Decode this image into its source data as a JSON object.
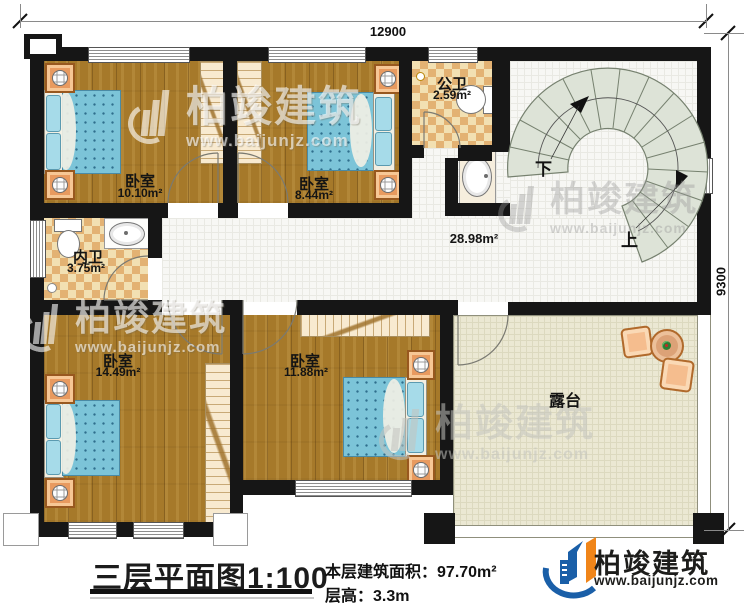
{
  "dims": {
    "width": "12900",
    "height": "9300"
  },
  "rooms": [
    {
      "name": "卧室",
      "area": "10.10m²"
    },
    {
      "name": "卧室",
      "area": "8.44m²"
    },
    {
      "name": "公卫",
      "area": "2.59m²"
    },
    {
      "name": "内卫",
      "area": "3.75m²"
    },
    {
      "name": "卧室",
      "area": "14.49m²"
    },
    {
      "name": "卧室",
      "area": "11.88m²"
    },
    {
      "name": "露台",
      "area": ""
    }
  ],
  "hall": {
    "area": "28.98m²"
  },
  "stairs": {
    "down": "下",
    "up": "上"
  },
  "title": {
    "name": "三层平面图",
    "scale": "1:100"
  },
  "stats": {
    "area_label": "本层建筑面积：",
    "area_value": "97.70m²",
    "height_label": "层高：",
    "height_value": "3.3m"
  },
  "brand": {
    "name": "柏竣建筑",
    "site": "www.baijunjz.com"
  }
}
